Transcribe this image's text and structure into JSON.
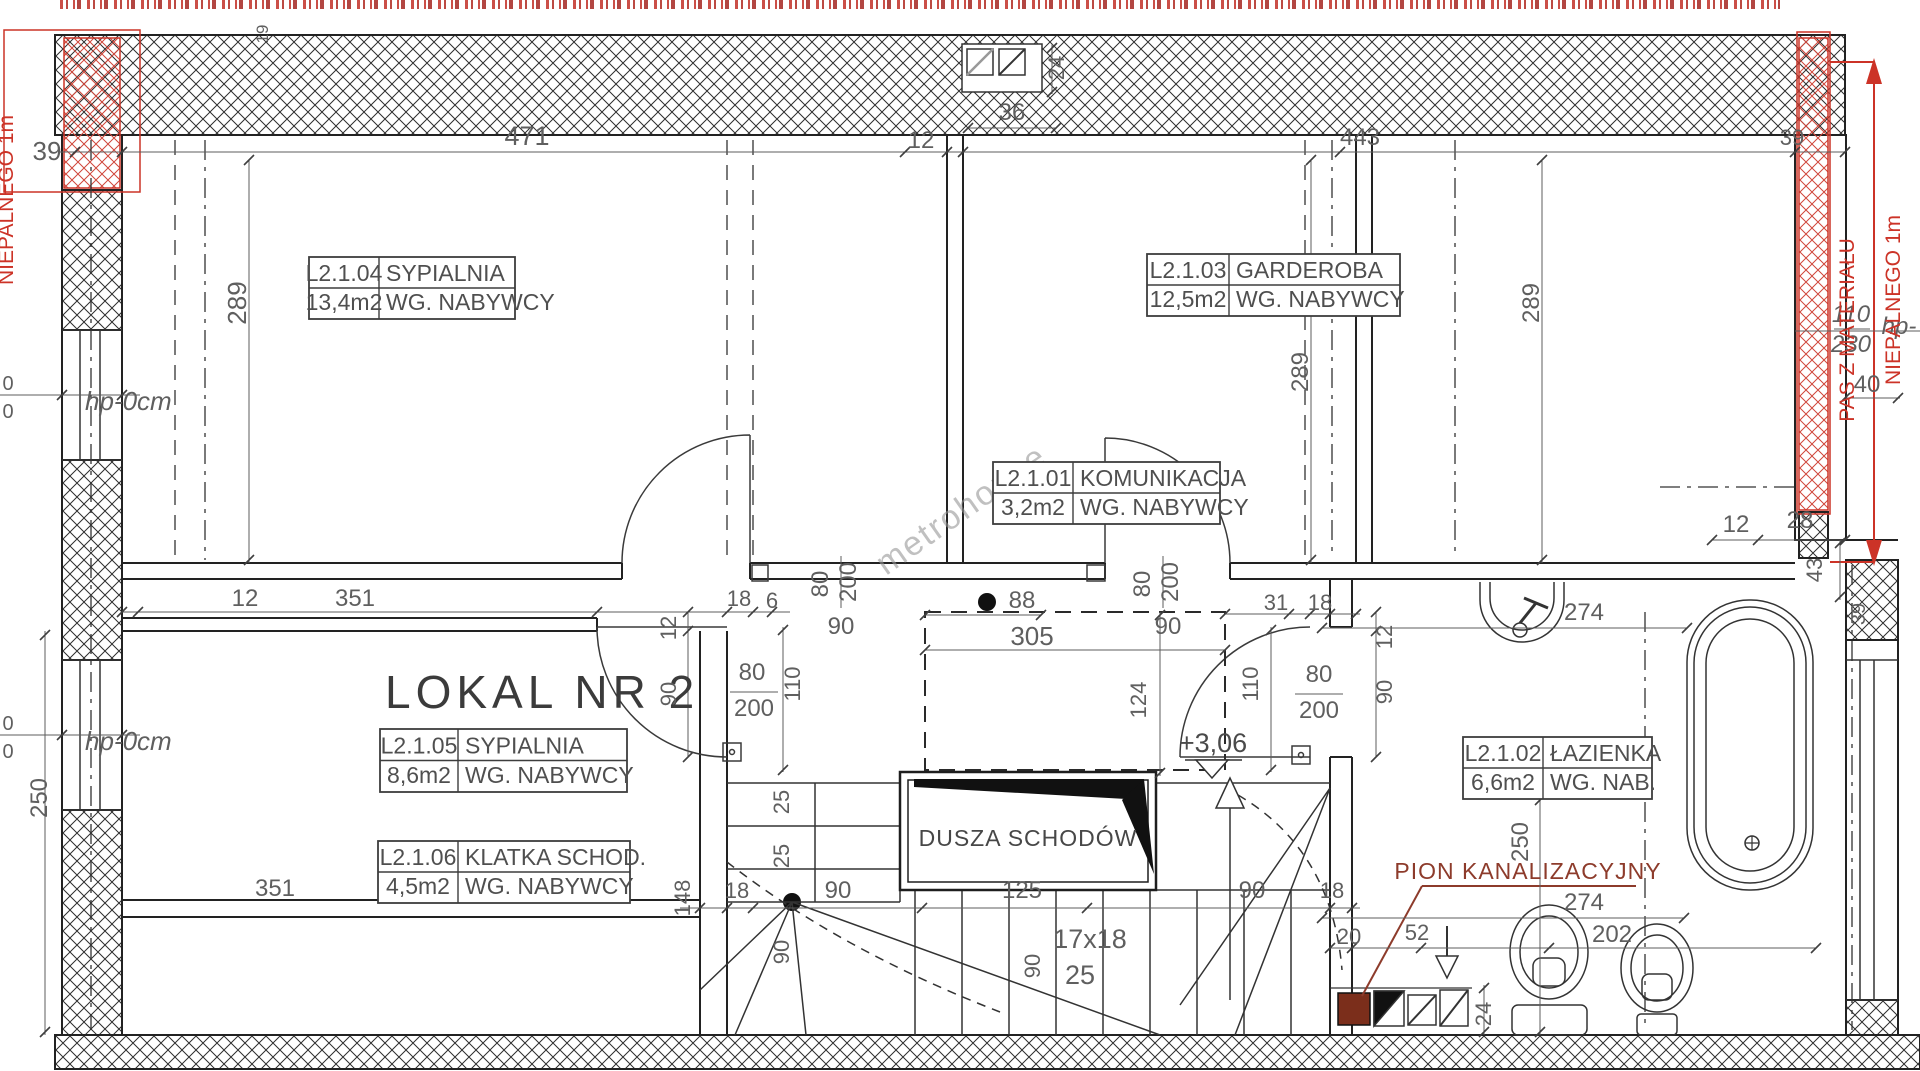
{
  "document": {
    "type": "architectural-floor-plan",
    "unit": "LOKAL NR 2"
  },
  "colors": {
    "ink": "#2a2a2a",
    "dim_text": "#5f5f5f",
    "red": "#cc3327",
    "sewage": "#8d3b2b",
    "sewage_fill": "#7b2e1b",
    "watermark": "rgba(150,150,150,0.6)"
  },
  "texts": {
    "unit_title": "LOKAL NR 2",
    "stair_void": "DUSZA SCHODÓW",
    "sewage_stack": "PION KANALIZACYJNY",
    "watermark": "metrohouse"
  },
  "rooms": [
    {
      "id": "L2.1.04",
      "name": "SYPIALNIA",
      "area": "13,4m2",
      "note": "WG. NABYWCY",
      "x": 309,
      "y": 257,
      "c1": 70,
      "c2": 136,
      "h": 62
    },
    {
      "id": "L2.1.03",
      "name": "GARDEROBA",
      "area": "12,5m2",
      "note": "WG. NABYWCY",
      "x": 1147,
      "y": 254,
      "c1": 82,
      "c2": 171,
      "h": 62
    },
    {
      "id": "L2.1.01",
      "name": "KOMUNIKACJA",
      "area": "3,2m2",
      "note": "WG. NABYWCY",
      "x": 993,
      "y": 462,
      "c1": 80,
      "c2": 147,
      "h": 62
    },
    {
      "id": "L2.1.05",
      "name": "SYPIALNIA",
      "area": "8,6m2",
      "note": "WG. NABYWCY",
      "x": 380,
      "y": 729,
      "c1": 78,
      "c2": 169,
      "h": 63
    },
    {
      "id": "L2.1.06",
      "name": "KLATKA SCHOD.",
      "area": "4,5m2",
      "note": "WG. NABYWCY",
      "x": 378,
      "y": 841,
      "c1": 80,
      "c2": 172,
      "h": 62
    },
    {
      "id": "L2.1.02",
      "name": "ŁAZIENKA",
      "area": "6,6m2",
      "note": "WG. NAB.",
      "x": 1463,
      "y": 737,
      "c1": 80,
      "c2": 109,
      "h": 62
    }
  ],
  "labels": [
    {
      "t": "19",
      "x": 268,
      "y": 34,
      "s": 17,
      "r": -90
    },
    {
      "t": "39",
      "x": 47,
      "y": 160,
      "s": 26
    },
    {
      "t": "471",
      "x": 527,
      "y": 145,
      "s": 27
    },
    {
      "t": "12",
      "x": 921,
      "y": 148,
      "s": 24
    },
    {
      "t": "36",
      "x": 1012,
      "y": 120,
      "s": 24
    },
    {
      "t": "24",
      "x": 1064,
      "y": 68,
      "s": 22,
      "r": -90
    },
    {
      "t": "443",
      "x": 1360,
      "y": 145,
      "s": 24
    },
    {
      "t": "39",
      "x": 1792,
      "y": 145,
      "s": 22
    },
    {
      "t": "289",
      "x": 246,
      "y": 303,
      "s": 26,
      "r": -90
    },
    {
      "t": "289",
      "x": 1308,
      "y": 372,
      "s": 24,
      "r": -90
    },
    {
      "t": "289",
      "x": 1539,
      "y": 303,
      "s": 24,
      "r": -90
    },
    {
      "t": "110",
      "x": 1851,
      "y": 322,
      "s": 24,
      "i": 1,
      "n": "sill-height-label"
    },
    {
      "t": "230",
      "x": 1851,
      "y": 352,
      "s": 24,
      "i": 1,
      "n": "sill-height-label"
    },
    {
      "t": "hp-",
      "x": 1899,
      "y": 334,
      "s": 24,
      "i": 1,
      "n": "sill-height-label"
    },
    {
      "t": "40",
      "x": 1867,
      "y": 392,
      "s": 24
    },
    {
      "t": "hp-0cm",
      "x": 85,
      "y": 410,
      "s": 26,
      "i": 1,
      "a": "start",
      "n": "sill-height-label"
    },
    {
      "t": "0",
      "x": 8,
      "y": 390,
      "s": 20
    },
    {
      "t": "0",
      "x": 8,
      "y": 418,
      "s": 20
    },
    {
      "t": "hp-0cm",
      "x": 85,
      "y": 750,
      "s": 26,
      "i": 1,
      "a": "start",
      "n": "sill-height-label"
    },
    {
      "t": "0",
      "x": 8,
      "y": 730,
      "s": 20
    },
    {
      "t": "0",
      "x": 8,
      "y": 758,
      "s": 20
    },
    {
      "t": "12",
      "x": 245,
      "y": 606,
      "s": 24
    },
    {
      "t": "351",
      "x": 355,
      "y": 606,
      "s": 24
    },
    {
      "t": "351",
      "x": 275,
      "y": 896,
      "s": 24
    },
    {
      "t": "18",
      "x": 739,
      "y": 606,
      "s": 22
    },
    {
      "t": "6",
      "x": 772,
      "y": 608,
      "s": 22
    },
    {
      "t": "90",
      "x": 841,
      "y": 634,
      "s": 24
    },
    {
      "t": "80",
      "x": 828,
      "y": 584,
      "s": 24,
      "r": -90
    },
    {
      "t": "200",
      "x": 856,
      "y": 582,
      "s": 24,
      "r": -90
    },
    {
      "t": "90",
      "x": 1168,
      "y": 634,
      "s": 24
    },
    {
      "t": "80",
      "x": 1150,
      "y": 584,
      "s": 24,
      "r": -90
    },
    {
      "t": "200",
      "x": 1178,
      "y": 582,
      "s": 24,
      "r": -90
    },
    {
      "t": "88",
      "x": 1022,
      "y": 608,
      "s": 24
    },
    {
      "t": "305",
      "x": 1032,
      "y": 645,
      "s": 26
    },
    {
      "t": "31",
      "x": 1276,
      "y": 610,
      "s": 22
    },
    {
      "t": "18",
      "x": 1320,
      "y": 610,
      "s": 22
    },
    {
      "t": "12",
      "x": 1392,
      "y": 637,
      "s": 22,
      "r": -90
    },
    {
      "t": "90",
      "x": 1392,
      "y": 692,
      "s": 22,
      "r": -90
    },
    {
      "t": "12",
      "x": 676,
      "y": 628,
      "s": 22,
      "r": -90
    },
    {
      "t": "90",
      "x": 676,
      "y": 694,
      "s": 22,
      "r": -90
    },
    {
      "t": "110",
      "x": 800,
      "y": 684,
      "s": 22,
      "r": -90
    },
    {
      "t": "80",
      "x": 752,
      "y": 680,
      "s": 24
    },
    {
      "t": "200",
      "x": 754,
      "y": 716,
      "s": 24
    },
    {
      "t": "110",
      "x": 1258,
      "y": 684,
      "s": 22,
      "r": -90
    },
    {
      "t": "80",
      "x": 1319,
      "y": 682,
      "s": 24
    },
    {
      "t": "200",
      "x": 1319,
      "y": 718,
      "s": 24
    },
    {
      "t": "124",
      "x": 1146,
      "y": 700,
      "s": 22,
      "r": -90
    },
    {
      "t": "+3,06",
      "x": 1213,
      "y": 752,
      "s": 27,
      "c": "#4a4a4a",
      "n": "level-mark"
    },
    {
      "t": "148",
      "x": 690,
      "y": 898,
      "s": 22,
      "r": -90
    },
    {
      "t": "18",
      "x": 737,
      "y": 898,
      "s": 22
    },
    {
      "t": "90",
      "x": 838,
      "y": 898,
      "s": 24
    },
    {
      "t": "125",
      "x": 1022,
      "y": 898,
      "s": 24
    },
    {
      "t": "90",
      "x": 1252,
      "y": 898,
      "s": 24
    },
    {
      "t": "18",
      "x": 1332,
      "y": 898,
      "s": 22
    },
    {
      "t": "25",
      "x": 789,
      "y": 802,
      "s": 22,
      "r": -90
    },
    {
      "t": "25",
      "x": 789,
      "y": 856,
      "s": 22,
      "r": -90
    },
    {
      "t": "90",
      "x": 789,
      "y": 952,
      "s": 22,
      "r": -90
    },
    {
      "t": "90",
      "x": 1040,
      "y": 966,
      "s": 22,
      "r": -90
    },
    {
      "t": "17x18",
      "x": 1090,
      "y": 948,
      "s": 27,
      "n": "stair-count-label"
    },
    {
      "t": "25",
      "x": 1080,
      "y": 984,
      "s": 27,
      "n": "stair-tread-label"
    },
    {
      "t": "250",
      "x": 47,
      "y": 798,
      "s": 24,
      "r": -90
    },
    {
      "t": "250",
      "x": 1528,
      "y": 842,
      "s": 24,
      "r": -90
    },
    {
      "t": "274",
      "x": 1584,
      "y": 620,
      "s": 24
    },
    {
      "t": "274",
      "x": 1584,
      "y": 910,
      "s": 24
    },
    {
      "t": "202",
      "x": 1612,
      "y": 942,
      "s": 24
    },
    {
      "t": "20",
      "x": 1349,
      "y": 944,
      "s": 22
    },
    {
      "t": "52",
      "x": 1417,
      "y": 940,
      "s": 22
    },
    {
      "t": "24",
      "x": 1491,
      "y": 1014,
      "s": 22,
      "r": -90
    },
    {
      "t": "12",
      "x": 1736,
      "y": 532,
      "s": 24
    },
    {
      "t": "28",
      "x": 1800,
      "y": 528,
      "s": 24
    },
    {
      "t": "43",
      "x": 1822,
      "y": 570,
      "s": 22,
      "r": -90
    },
    {
      "t": "39",
      "x": 1865,
      "y": 614,
      "s": 20,
      "r": -90
    },
    {
      "t": "metrohouse",
      "x": 886,
      "y": 576,
      "s": 34,
      "r": -35,
      "c": "rgba(150,150,150,0.6)",
      "a": "start",
      "ls": 2,
      "n": "watermark"
    },
    {
      "t": "PAS Z MATERIAŁU",
      "x": 1854,
      "y": 330,
      "s": 21,
      "r": -90,
      "c": "#cc3327",
      "n": "fireproof-band-note"
    },
    {
      "t": "NIEPALNEGO 1m",
      "x": 1900,
      "y": 300,
      "s": 21,
      "r": -90,
      "c": "#cc3327",
      "n": "fireproof-band-note"
    },
    {
      "t": "NIEPALNEGO 1m",
      "x": 13,
      "y": 200,
      "s": 21,
      "r": -90,
      "c": "#cc3327",
      "n": "fireproof-band-note"
    }
  ]
}
